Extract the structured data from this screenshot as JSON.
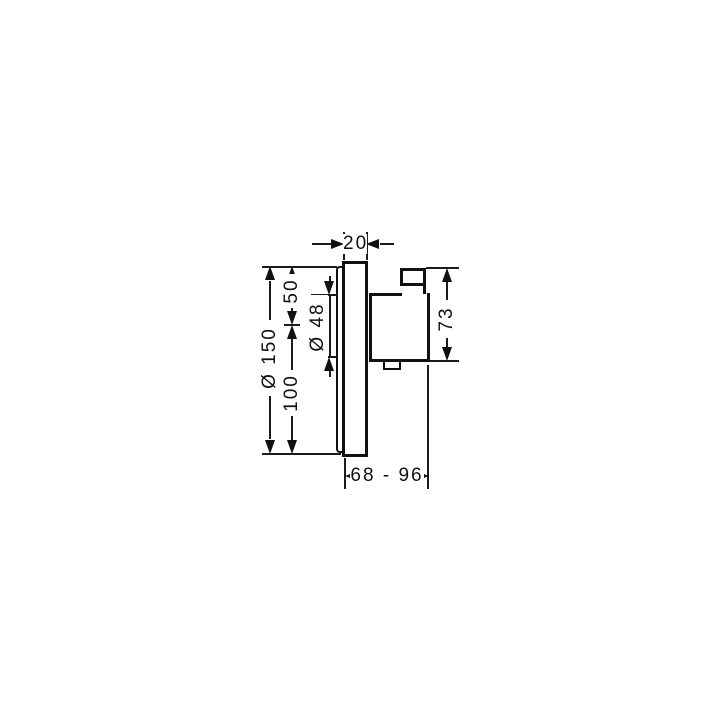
{
  "drawing": {
    "kind": "thermostat-valve-dimension-drawing",
    "colors": {
      "line": "#111111",
      "background": "#ffffff"
    },
    "labels": {
      "plate_thickness": "20",
      "upper_offset": "50",
      "cartridge_diameter": "Ø 48",
      "plate_diameter": "Ø 150",
      "lower_offset": "100",
      "body_height": "73",
      "installation_depth": "68 - 96"
    }
  }
}
